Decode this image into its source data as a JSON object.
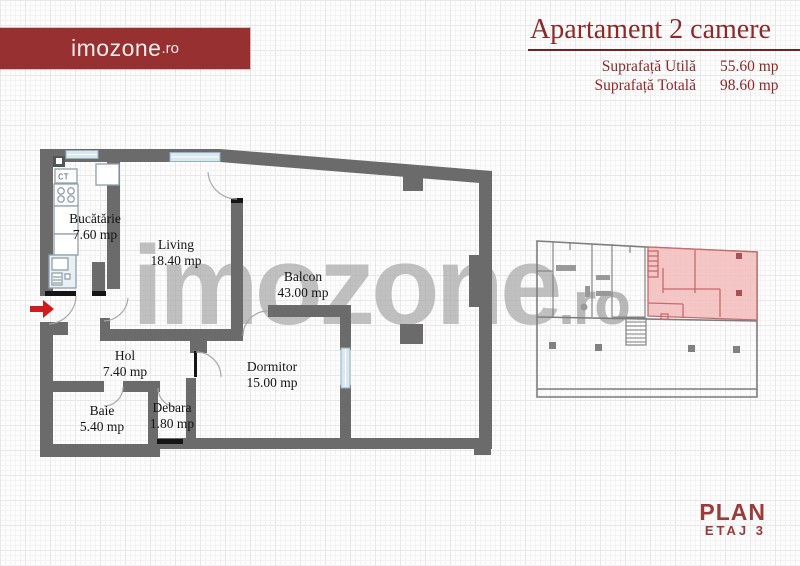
{
  "brand": {
    "logo_text": "imozone",
    "logo_tld": ".ro"
  },
  "header": {
    "title": "Apartament 2 camere",
    "specs": [
      {
        "label": "Suprafață Utilă",
        "value": "55.60 mp"
      },
      {
        "label": "Suprafață Totală",
        "value": "98.60 mp"
      }
    ]
  },
  "watermark": {
    "text": "imozone",
    "tld": ".ro"
  },
  "rooms": [
    {
      "name": "Bucătărie",
      "area": "7.60 mp"
    },
    {
      "name": "Living",
      "area": "18.40 mp"
    },
    {
      "name": "Balcon",
      "area": "43.00 mp"
    },
    {
      "name": "Hol",
      "area": "7.40 mp"
    },
    {
      "name": "Dormitor",
      "area": "15.00 mp"
    },
    {
      "name": "Baie",
      "area": "5.40 mp"
    },
    {
      "name": "Debara",
      "area": "1.80 mp"
    }
  ],
  "fixtures": {
    "ct_label": "CT"
  },
  "footer": {
    "plan": "PLAN",
    "etaj": "ETAJ 3"
  },
  "colors": {
    "brand_red": "#973131",
    "title_red": "#8c2a2a",
    "wall_gray": "#6b6b6b",
    "watermark_gray": "#a9a9a9",
    "window_blue": "#d9e8f0",
    "highlight_pink": "#f3bcbc",
    "highlight_border": "#c86a6a",
    "arrow_red": "#cf1d1d"
  }
}
